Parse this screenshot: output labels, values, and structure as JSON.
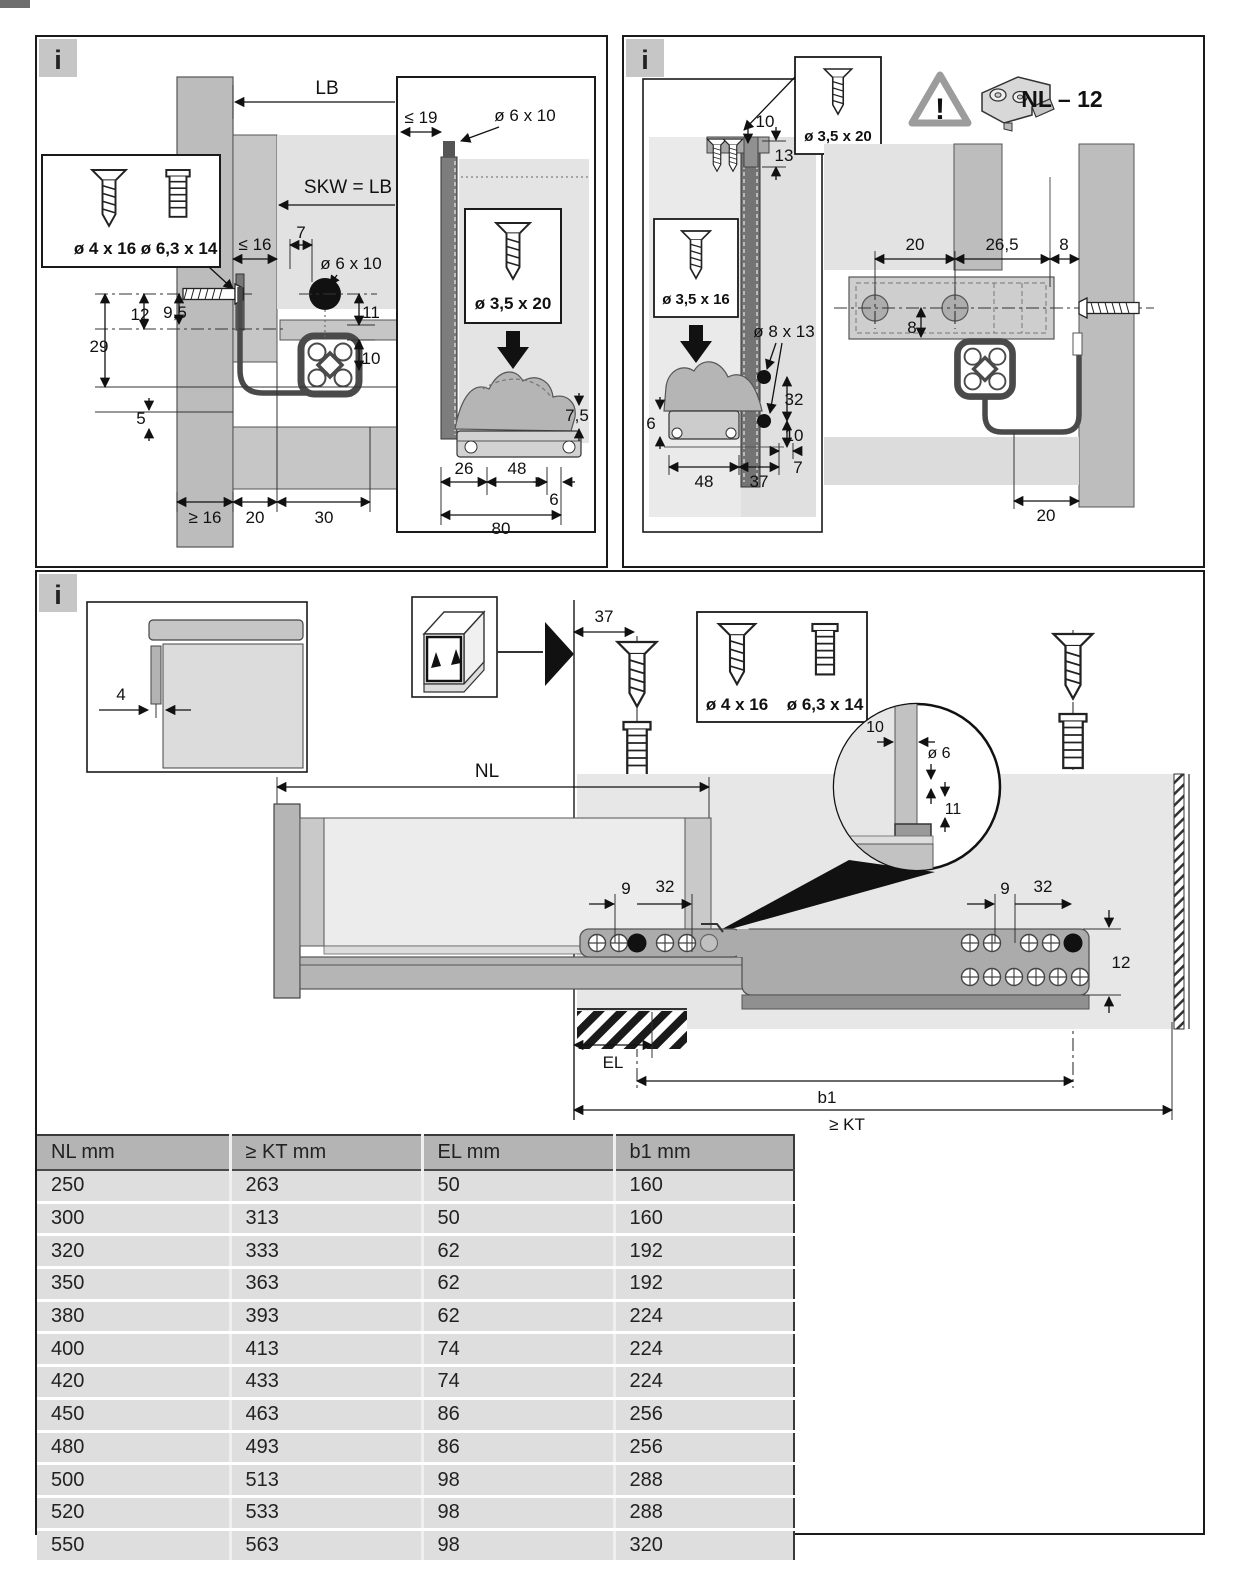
{
  "page": {
    "info_label": "i"
  },
  "colors": {
    "panel_border": "#1a1a1a",
    "light_gray": "#e5e5e5",
    "mid_gray": "#c0c0c0",
    "wall_gray": "#bcbcbc",
    "dark_bar_gray": "#767676",
    "rail_dark": "#4a4a4a",
    "table_header_bg": "#b4b4b4",
    "table_row_bg": "#dedede"
  },
  "panel_top_left": {
    "screw_box": {
      "screw1": "ø 4 x 16",
      "screw2": "ø 6,3 x 14"
    },
    "dims": {
      "lb": "LB",
      "skw": "SKW = LB - 40",
      "le16": "≤ 16",
      "d7": "7",
      "hole": "ø 6 x 10",
      "d11": "11",
      "d12": "12",
      "d9_5": "9,5",
      "d29": "29",
      "d10": "10",
      "d5": "5",
      "ge16": "≥ 16",
      "d20": "20",
      "d30": "30"
    },
    "detail": {
      "le19": "≤ 19",
      "hole": "ø 6 x 10",
      "screw": "ø 3,5 x 20",
      "d7_5": "7,5",
      "d26": "26",
      "d48": "48",
      "d6": "6",
      "d80": "80"
    }
  },
  "panel_top_right": {
    "screw_top": "ø 3,5 x 20",
    "screw_mid": "ø 3,5 x 16",
    "warning_icon": "!",
    "part_label": "NL – 12",
    "back_dims": {
      "d10": "10",
      "d13": "13",
      "hole": "ø 8 x 13",
      "d32": "32",
      "d10b": "10",
      "d6": "6",
      "d48": "48",
      "d37": "37",
      "d7": "7"
    },
    "side_dims": {
      "d20": "20",
      "d26_5": "26,5",
      "d8": "8",
      "d8b": "8",
      "d20b": "20"
    }
  },
  "panel_bottom": {
    "corner_dim": "4",
    "d37": "37",
    "screw_box": {
      "screw1": "ø 4 x 16",
      "screw2": "ø 6,3 x 14"
    },
    "nl": "NL",
    "magnifier": {
      "d10": "10",
      "dia6": "ø 6",
      "d11": "11"
    },
    "left_dims": {
      "d9": "9",
      "d32": "32"
    },
    "right_dims": {
      "d9": "9",
      "d32": "32",
      "d12": "12"
    },
    "el": "EL",
    "b1": "b1",
    "kt": "≥ KT"
  },
  "table": {
    "headers": [
      "NL mm",
      "≥ KT mm",
      "EL mm",
      "b1 mm"
    ],
    "rows": [
      [
        "250",
        "263",
        "50",
        "160"
      ],
      [
        "300",
        "313",
        "50",
        "160"
      ],
      [
        "320",
        "333",
        "62",
        "192"
      ],
      [
        "350",
        "363",
        "62",
        "192"
      ],
      [
        "380",
        "393",
        "62",
        "224"
      ],
      [
        "400",
        "413",
        "74",
        "224"
      ],
      [
        "420",
        "433",
        "74",
        "224"
      ],
      [
        "450",
        "463",
        "86",
        "256"
      ],
      [
        "480",
        "493",
        "86",
        "256"
      ],
      [
        "500",
        "513",
        "98",
        "288"
      ],
      [
        "520",
        "533",
        "98",
        "288"
      ],
      [
        "550",
        "563",
        "98",
        "320"
      ]
    ]
  }
}
